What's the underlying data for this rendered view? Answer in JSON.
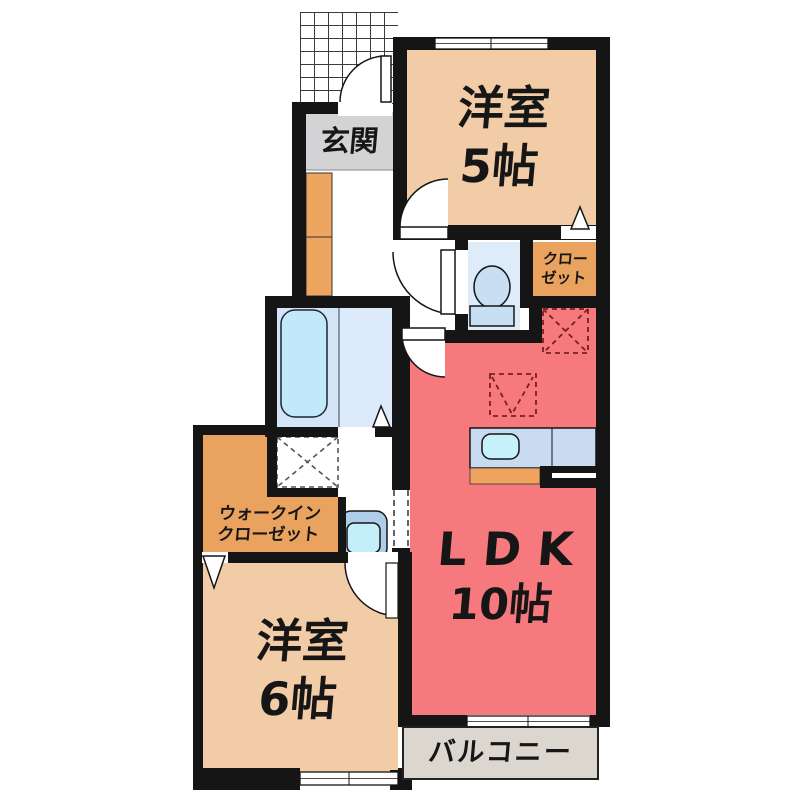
{
  "floorplan": {
    "labels": {
      "genkan": "玄関",
      "room5": {
        "name": "洋室",
        "size": "5帖"
      },
      "closet": {
        "line1": "クロー",
        "line2": "ゼット"
      },
      "ldk": {
        "name": "LDK",
        "size": "10帖"
      },
      "wic": {
        "line1": "ウォークイン",
        "line2": "クローゼット"
      },
      "room6": {
        "name": "洋室",
        "size": "6帖"
      },
      "balcony": "バルコニー"
    },
    "colors": {
      "wall": "#151515",
      "western_room": "#F2CBA7",
      "ldk_red": "#F5797D",
      "storage_orange": "#E9A35F",
      "genkan_gray": "#D3D3D5",
      "bath_floor_blue": "#D3E5F6",
      "fixture_blue": "#C6EDFA",
      "counter_blue": "#C9DBF0",
      "balcony_gray": "#DBD6CE"
    },
    "fixtures": [
      "toilet",
      "bathtub",
      "washbasin",
      "kitchen-sink",
      "refrigerator-space",
      "washer-space",
      "shoe-cabinet"
    ]
  }
}
